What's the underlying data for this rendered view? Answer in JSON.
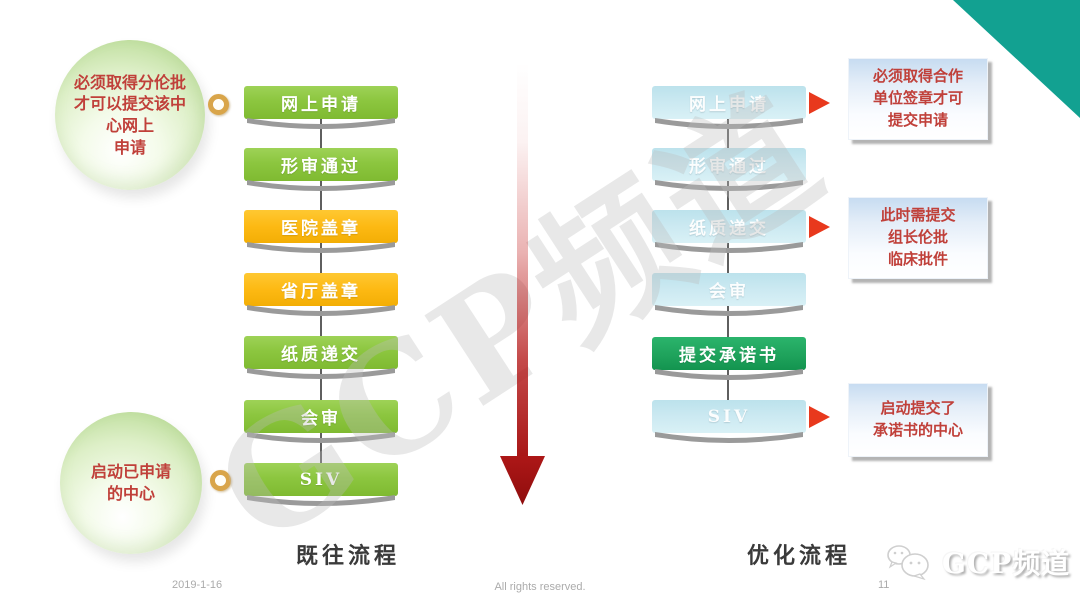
{
  "slide": {
    "watermark": "GCP频道",
    "corner_accent_color": "#12A191",
    "footer": {
      "date": "2019-1-16",
      "copyright": "All rights reserved.",
      "page_number": "11"
    },
    "brand": {
      "name": "GCP频道",
      "icon": "wechat-bubbles-icon"
    }
  },
  "legacy_flow": {
    "label": "既往流程",
    "steps": [
      {
        "text": "网上申请",
        "color": "#8CC63F"
      },
      {
        "text": "形审通过",
        "color": "#8CC63F"
      },
      {
        "text": "医院盖章",
        "color": "#FDB913"
      },
      {
        "text": "省厅盖章",
        "color": "#FDB913"
      },
      {
        "text": "纸质递交",
        "color": "#8CC63F"
      },
      {
        "text": "会审",
        "color": "#8CC63F"
      },
      {
        "text": "SIV",
        "color": "#8CC63F"
      }
    ],
    "callout_top": "必须取得分伦批\n才可以提交该中\n心网上\n申请",
    "callout_bottom": "启动已申请\n的中心",
    "callout_text_color": "#c0403a",
    "link_icon": "gold-ring-icon"
  },
  "optimized_flow": {
    "label": "优化流程",
    "steps": [
      {
        "text": "网上申请",
        "color": "#CDEAF2"
      },
      {
        "text": "形审通过",
        "color": "#CDEAF2"
      },
      {
        "text": "纸质递交",
        "color": "#CDEAF2"
      },
      {
        "text": "会审",
        "color": "#CDEAF2"
      },
      {
        "text": "提交承诺书",
        "color": "#1FA35C"
      },
      {
        "text": "SIV",
        "color": "#CDEAF2"
      }
    ],
    "annotations": [
      "必须取得合作\n单位签章才可\n提交申请",
      "此时需提交\n组长伦批\n临床批件",
      "启动提交了\n承诺书的中心"
    ],
    "annotation_text_color": "#c0403a",
    "pointer_icon": "red-right-arrow-icon",
    "pointer_color": "#E8391D"
  },
  "center_arrow": {
    "direction": "down",
    "color": "#A81616"
  }
}
